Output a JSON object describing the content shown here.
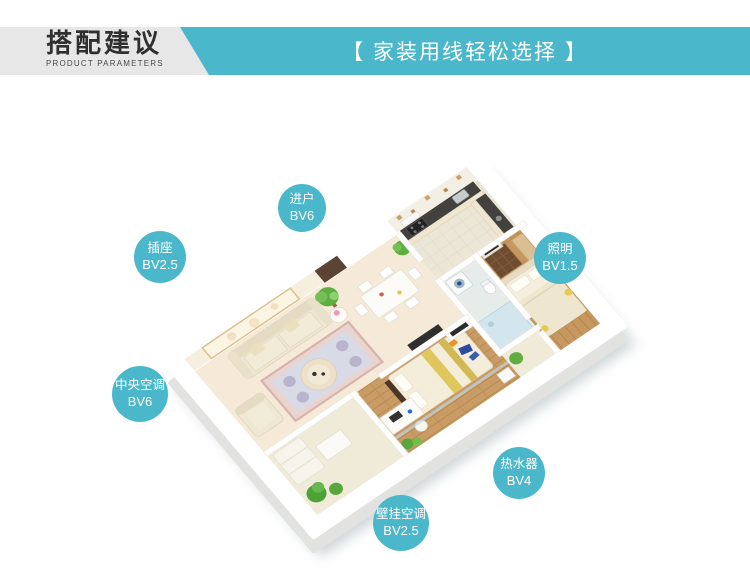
{
  "header": {
    "title": "搭配建议",
    "subtitle": "PRODUCT PARAMETERS",
    "banner": "【 家装用线轻松选择 】"
  },
  "colors": {
    "accent": "#4bb7cb",
    "header_band": "#e7e7e7",
    "title_text": "#303030",
    "banner_text": "#ffffff"
  },
  "callouts": [
    {
      "id": "entry",
      "label": "进户",
      "spec": "BV6",
      "x": 302,
      "y": 208,
      "r": 24
    },
    {
      "id": "socket",
      "label": "插座",
      "spec": "BV2.5",
      "x": 160,
      "y": 257,
      "r": 26
    },
    {
      "id": "lighting",
      "label": "照明",
      "spec": "BV1.5",
      "x": 560,
      "y": 258,
      "r": 26
    },
    {
      "id": "central-ac",
      "label": "中央空调",
      "spec": "BV6",
      "x": 140,
      "y": 394,
      "r": 28
    },
    {
      "id": "water-heater",
      "label": "热水器",
      "spec": "BV4",
      "x": 519,
      "y": 473,
      "r": 26
    },
    {
      "id": "wall-ac",
      "label": "壁挂空调",
      "spec": "BV2.5",
      "x": 401,
      "y": 523,
      "r": 28
    }
  ]
}
